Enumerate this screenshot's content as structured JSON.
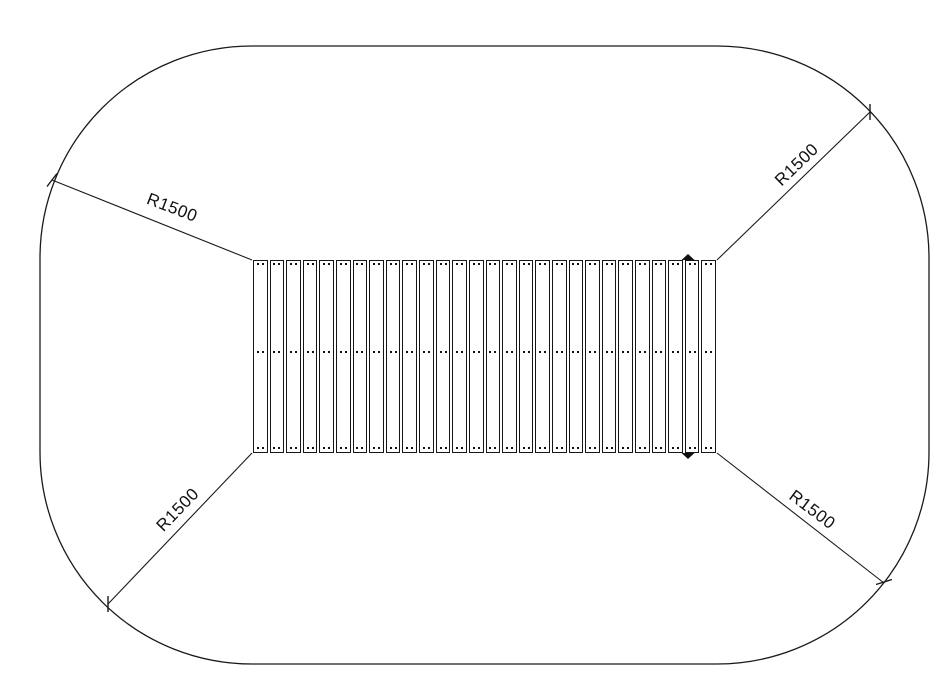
{
  "drawing": {
    "radius_labels": [
      {
        "position": "top-left",
        "text": "R1500"
      },
      {
        "position": "top-right",
        "text": "R1500"
      },
      {
        "position": "bottom-left",
        "text": "R1500"
      },
      {
        "position": "bottom-right",
        "text": "R1500"
      }
    ],
    "deck": {
      "plank_count": 28,
      "fastener_rows": [
        "top",
        "middle",
        "bottom"
      ],
      "fasteners_per_row_per_plank": 2,
      "marker_arrow_count": 2
    },
    "colors": {
      "line": "#1a1a1a",
      "background": "#ffffff"
    }
  }
}
